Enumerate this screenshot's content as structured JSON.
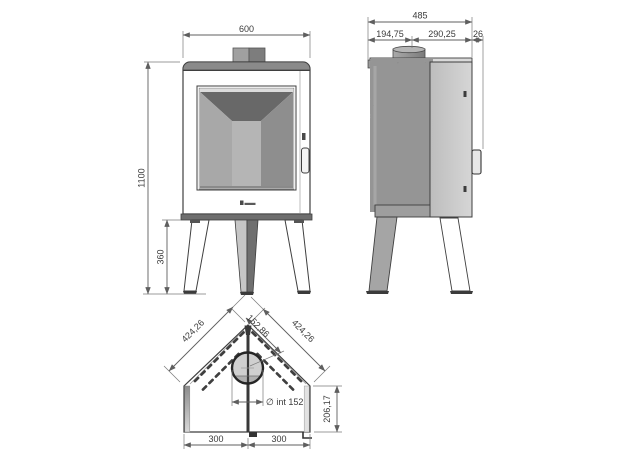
{
  "drawing": {
    "subject": "corner-stove-dimension-drawing",
    "background": "#ffffff"
  },
  "colors": {
    "outline": "#3f3f3f",
    "dimension_line": "#5f5f5f",
    "text": "#3a3a3a",
    "glass_dark": "#686868",
    "panel_mid": "#a8a8a8",
    "stone_base": "#969696",
    "metal_light": "#c9c9c9"
  },
  "views": {
    "front": {
      "dims": {
        "width": "600",
        "height": "1100",
        "leg_height": "360"
      }
    },
    "side": {
      "dims": {
        "total_depth": "485",
        "rear_to_flue": "194,75",
        "flue_to_front": "290,25",
        "handle_depth": "26"
      }
    },
    "bottom": {
      "dims": {
        "left_edge": "424,26",
        "flue_offset": "152,86",
        "right_edge": "424,26",
        "flue_inner_diameter": "∅ int 152",
        "rear_panel_depth": "206,17",
        "bottom_left": "300",
        "bottom_right": "300"
      }
    }
  }
}
